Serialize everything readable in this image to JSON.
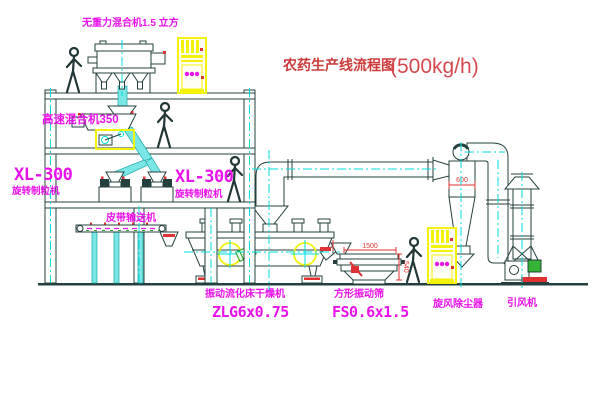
{
  "title": {
    "text_cn": "农药生产线流程图",
    "capacity": "(500kg/h)"
  },
  "labels": {
    "gravity_mixer": "无重力混合机1.5 立方",
    "high_speed_mixer": "高速混合机350",
    "granulator_left_model": "XL-300",
    "granulator_left_name": "旋转制粒机",
    "granulator_right_model": "XL-300",
    "granulator_right_name": "旋转制粒机",
    "belt_conveyor": "皮带输送机",
    "fluid_bed_name": "振动流化床干燥机",
    "fluid_bed_model": "ZLG6x0.75",
    "sieve_name": "方形振动筛",
    "sieve_model": "FS0.6x1.5",
    "cyclone": "旋风除尘器",
    "fan": "引风机"
  },
  "dimensions": {
    "sieve_length": "1500",
    "sieve_height": "540",
    "cyclone_diameter": "600"
  },
  "colors": {
    "line": "#24403e",
    "centerline": "#00dede",
    "label": "#ea12ea",
    "annotation": "#e03232",
    "highlight": "#f2f20a",
    "title": "#cc3a3a"
  }
}
